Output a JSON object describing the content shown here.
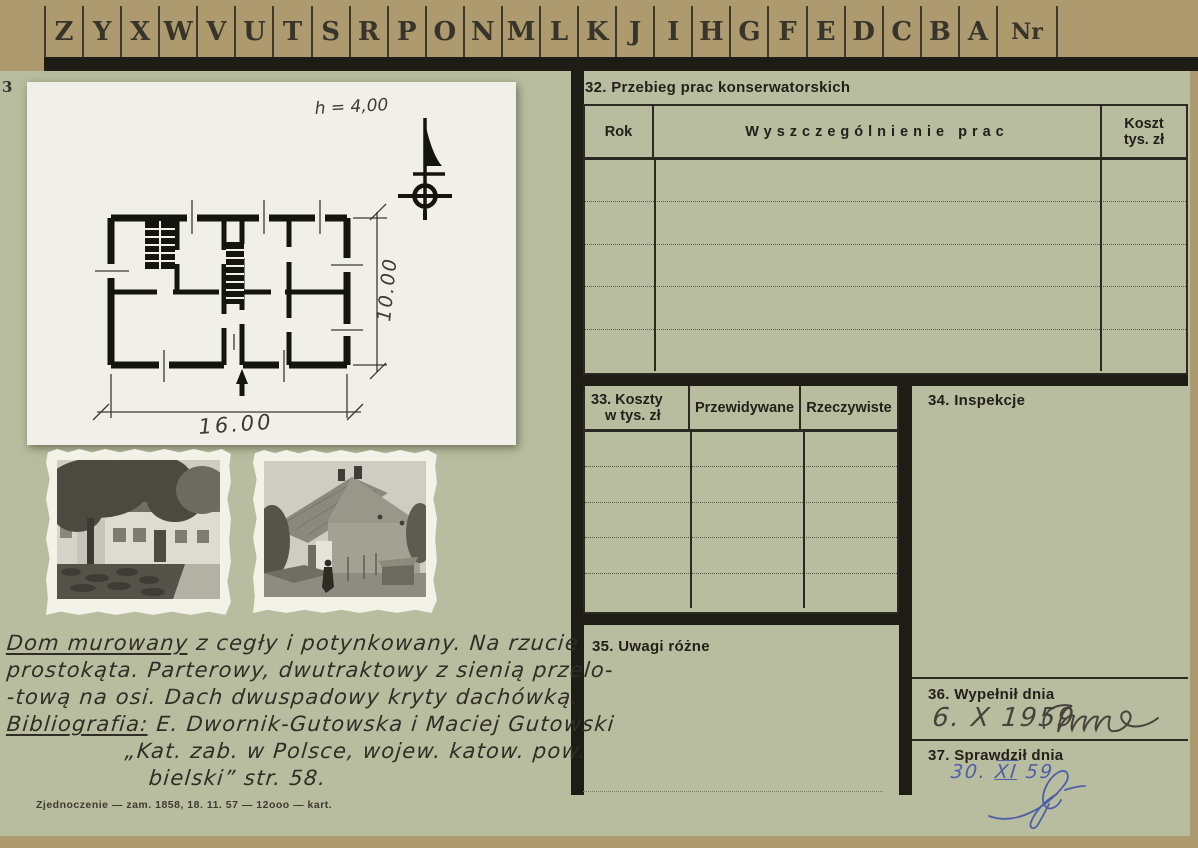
{
  "tabs": {
    "letters": [
      "Z",
      "Y",
      "X",
      "W",
      "V",
      "U",
      "T",
      "S",
      "R",
      "P",
      "O",
      "N",
      "M",
      "L",
      "K",
      "J",
      "I",
      "H",
      "G",
      "F",
      "E",
      "D",
      "C",
      "B",
      "A"
    ],
    "nr_label": "Nr"
  },
  "left": {
    "cutoff_digit": "3",
    "plan": {
      "annotation": "h = 4,00",
      "dim_width": "16.00",
      "dim_height": "10.00",
      "north_symbol": "compass-north-arrow"
    },
    "handwriting": {
      "line1_underlined": "Dom murowany",
      "line1_rest": " z cegły i potynkowany. Na rzucie",
      "line2": "prostokąta. Parterowy, dwutraktowy z sienią przelo-",
      "line3": "-tową na osi. Dach dwuspadowy kryty dachówką.",
      "bib_label": "Bibliografia:",
      "bib_rest": " E. Dwornik-Gutowska i Maciej Gutowski",
      "bib_line2": "„Kat. zab. w Polsce, wojew. katow. pow.",
      "bib_line3": "bielski”  str. 58."
    },
    "imprint": "Zjednoczenie — zam. 1858, 18. 11. 57 — 12ooo — kart."
  },
  "form": {
    "s32": {
      "title": "32. Przebieg prac konserwatorskich",
      "col_rok": "Rok",
      "col_prace": "Wyszczególnienie prac",
      "col_koszt_l1": "Koszt",
      "col_koszt_l2": "tys. zł",
      "row_count": 5
    },
    "s33": {
      "title_l1": "33. Koszty",
      "title_l2": "w tys. zł",
      "col_przewidywane": "Przewidywane",
      "col_rzeczywiste": "Rzeczywiste",
      "row_count": 5
    },
    "s34": {
      "title": "34. Inspekcje"
    },
    "s35": {
      "title": "35. Uwagi różne"
    },
    "s36": {
      "title": "36. Wypełnił dnia",
      "date": "6. X 1959",
      "signature": "illegible"
    },
    "s37": {
      "title": "37. Sprawdził dnia",
      "date_day": "30.",
      "date_month": "XI",
      "date_year": "59",
      "signature": "illegible"
    }
  },
  "colors": {
    "mat": "#ad9a6e",
    "card": "#b8bd9f",
    "ink": "#21211a",
    "blue_ink": "#4d5fa8",
    "sheet": "#f0efe8"
  }
}
